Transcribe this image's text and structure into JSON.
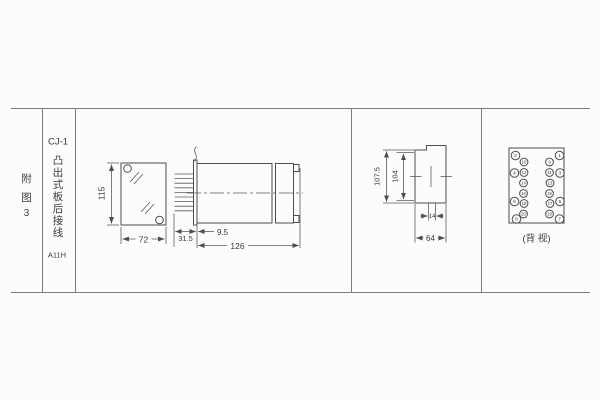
{
  "header": {
    "figure_chars": [
      "附",
      "图",
      "3"
    ],
    "model": "CJ-1",
    "subtitle_chars": [
      "凸",
      "出",
      "式",
      "板",
      "后",
      "接",
      "线"
    ],
    "code": "A11H"
  },
  "front_view": {
    "height": "115",
    "width": "72"
  },
  "side_view": {
    "terminal_depth": "31.5",
    "inset": "9.5",
    "length": "126"
  },
  "cutout_view": {
    "outer_height": "107.5",
    "inner_height": "104",
    "slot_width": "14",
    "width": "64"
  },
  "back_view": {
    "caption": "(背 视)",
    "terminals": {
      "outer_left": [
        "2",
        "4",
        "6",
        "8"
      ],
      "inner_left": [
        "10",
        "12",
        "14",
        "16",
        "18",
        "20"
      ],
      "inner_right": [
        "9",
        "11",
        "13",
        "15",
        "17",
        "19"
      ],
      "outer_right": [
        "1",
        "3",
        "5",
        "7"
      ]
    }
  },
  "colors": {
    "line": "#4d4d4d",
    "table_line": "#7a7a7a",
    "background": "#fcfcfc",
    "text": "#3a3a3a"
  }
}
